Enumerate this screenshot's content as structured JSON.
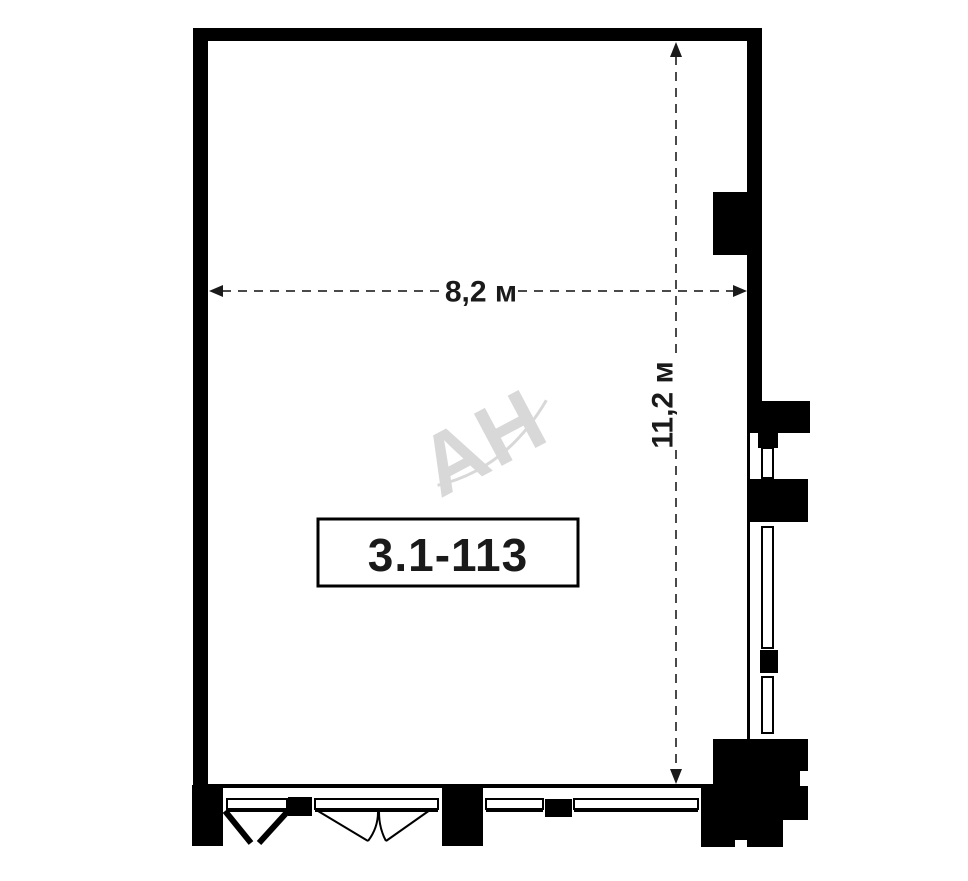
{
  "plan": {
    "unit_label": "3.1-113",
    "width_dimension": "8,2 м",
    "height_dimension": "11,2 м",
    "watermark": "АН"
  },
  "colors": {
    "background": "#ffffff",
    "wall": "#000000",
    "dimension_line": "#4a4a4a",
    "arrow": "#1a1a1a",
    "text": "#1a1a1a",
    "watermark": "#d8d8d8"
  }
}
